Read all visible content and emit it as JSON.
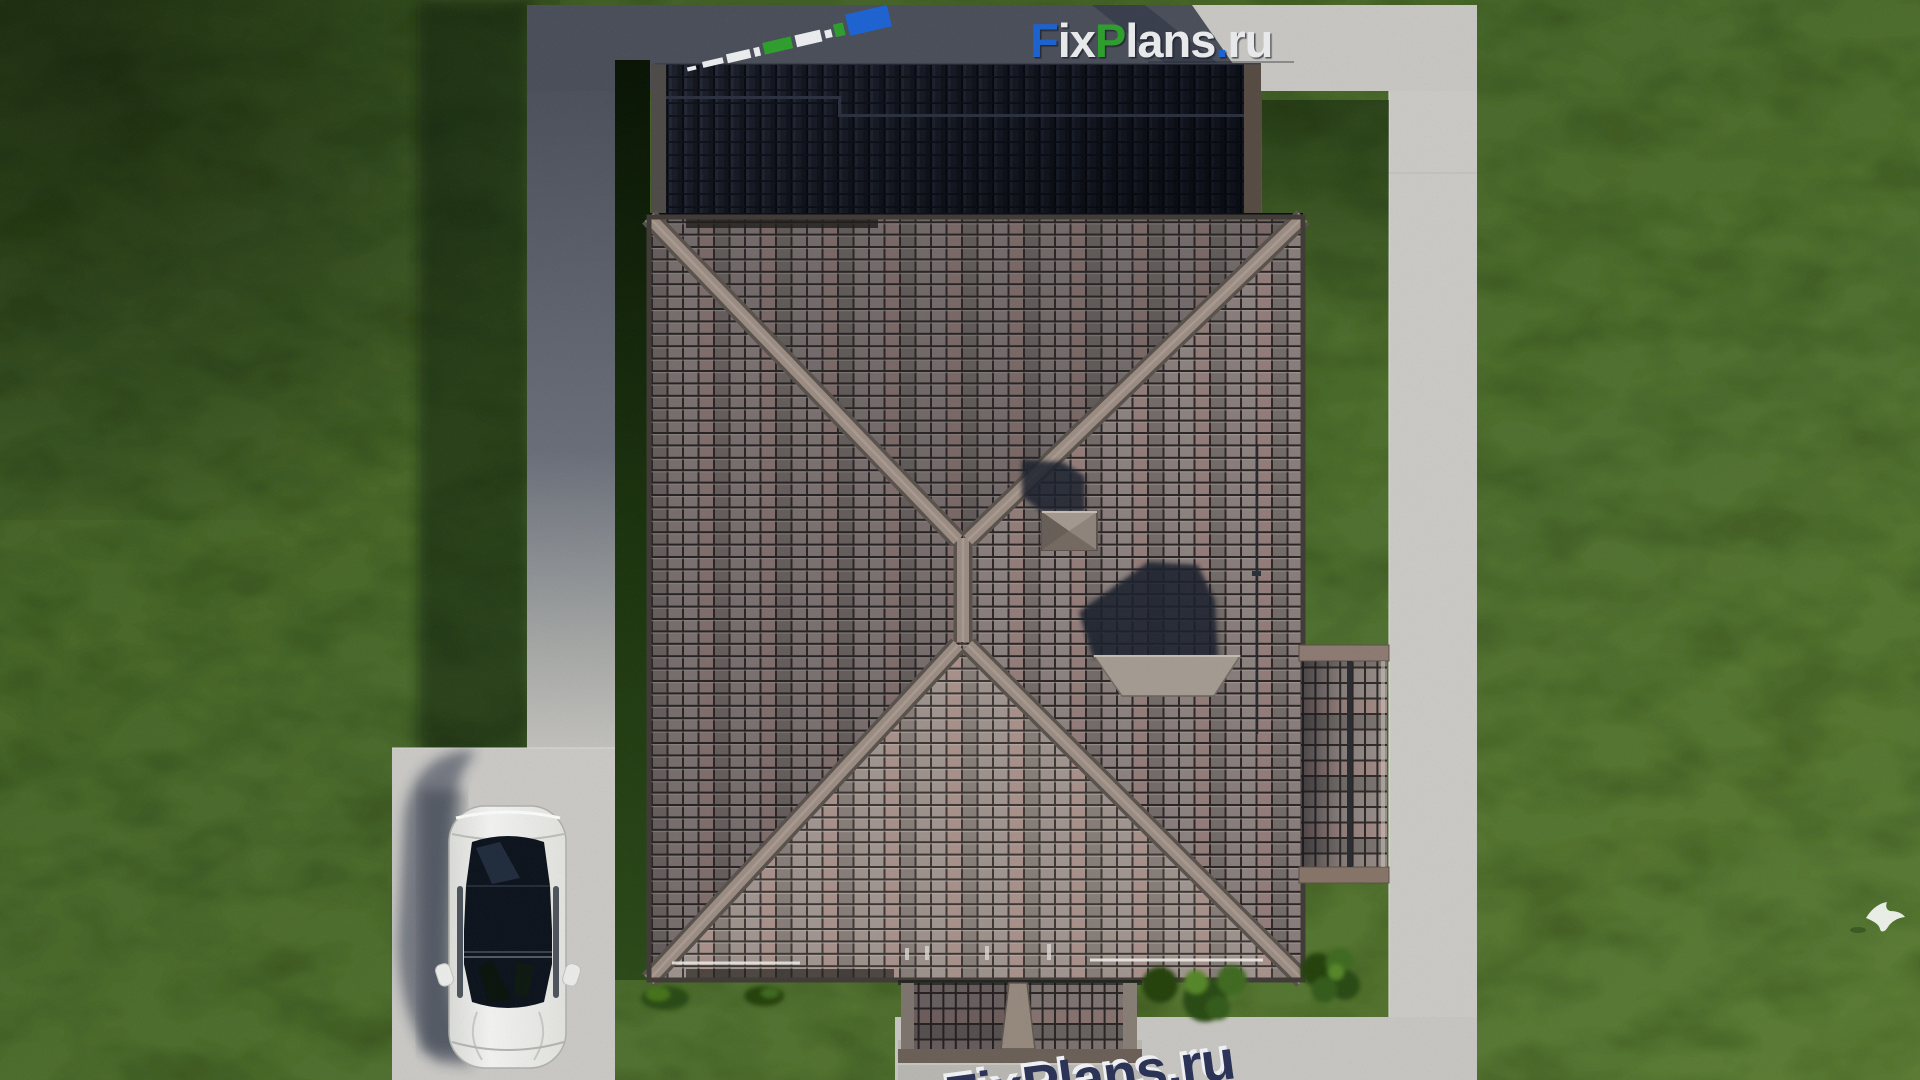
{
  "watermarks": {
    "top": {
      "text": "FixPlans.ru",
      "segments": [
        {
          "text": "F",
          "color": "#1f63d0"
        },
        {
          "text": "ix",
          "color": "#e7e9eb"
        },
        {
          "text": "P",
          "color": "#2f9e2f"
        },
        {
          "text": "lans",
          "color": "#e7e9eb"
        },
        {
          "text": ".",
          "color": "#1f63d0"
        },
        {
          "text": "ru",
          "color": "#e7e9eb"
        }
      ]
    },
    "bottom": {
      "text": "FixPlans.ru",
      "color": "#2b3357",
      "outline": "#eef0f4"
    },
    "mini": {
      "white": "#e9ebed",
      "green": "#2f9e2f",
      "blue": "#1f63d0"
    }
  },
  "palette": {
    "lawn_base": "#4a682c",
    "lawn_shadow": "#16300c",
    "concrete_lit": "#c7c6c2",
    "concrete_shadow": "#454a55",
    "roof_tile_light": "#998f8b",
    "roof_tile_mauve": "#a18a85",
    "roof_tile_dark": "#423e3e",
    "roof_dark_section": "#1f242f",
    "ridge": "#9a8c82",
    "car_body": "#e9eae7",
    "car_glass": "#0f151e",
    "bush_green": "#3f6a22"
  },
  "scene": {
    "objects": [
      "hip-roof-house",
      "shadowed-upper-roof",
      "side-terrace-roof",
      "porch-roof",
      "chimney",
      "vent-stack",
      "concrete-path-loop",
      "driveway",
      "white-sedan-car",
      "lawn",
      "bushes",
      "white-bird"
    ]
  }
}
